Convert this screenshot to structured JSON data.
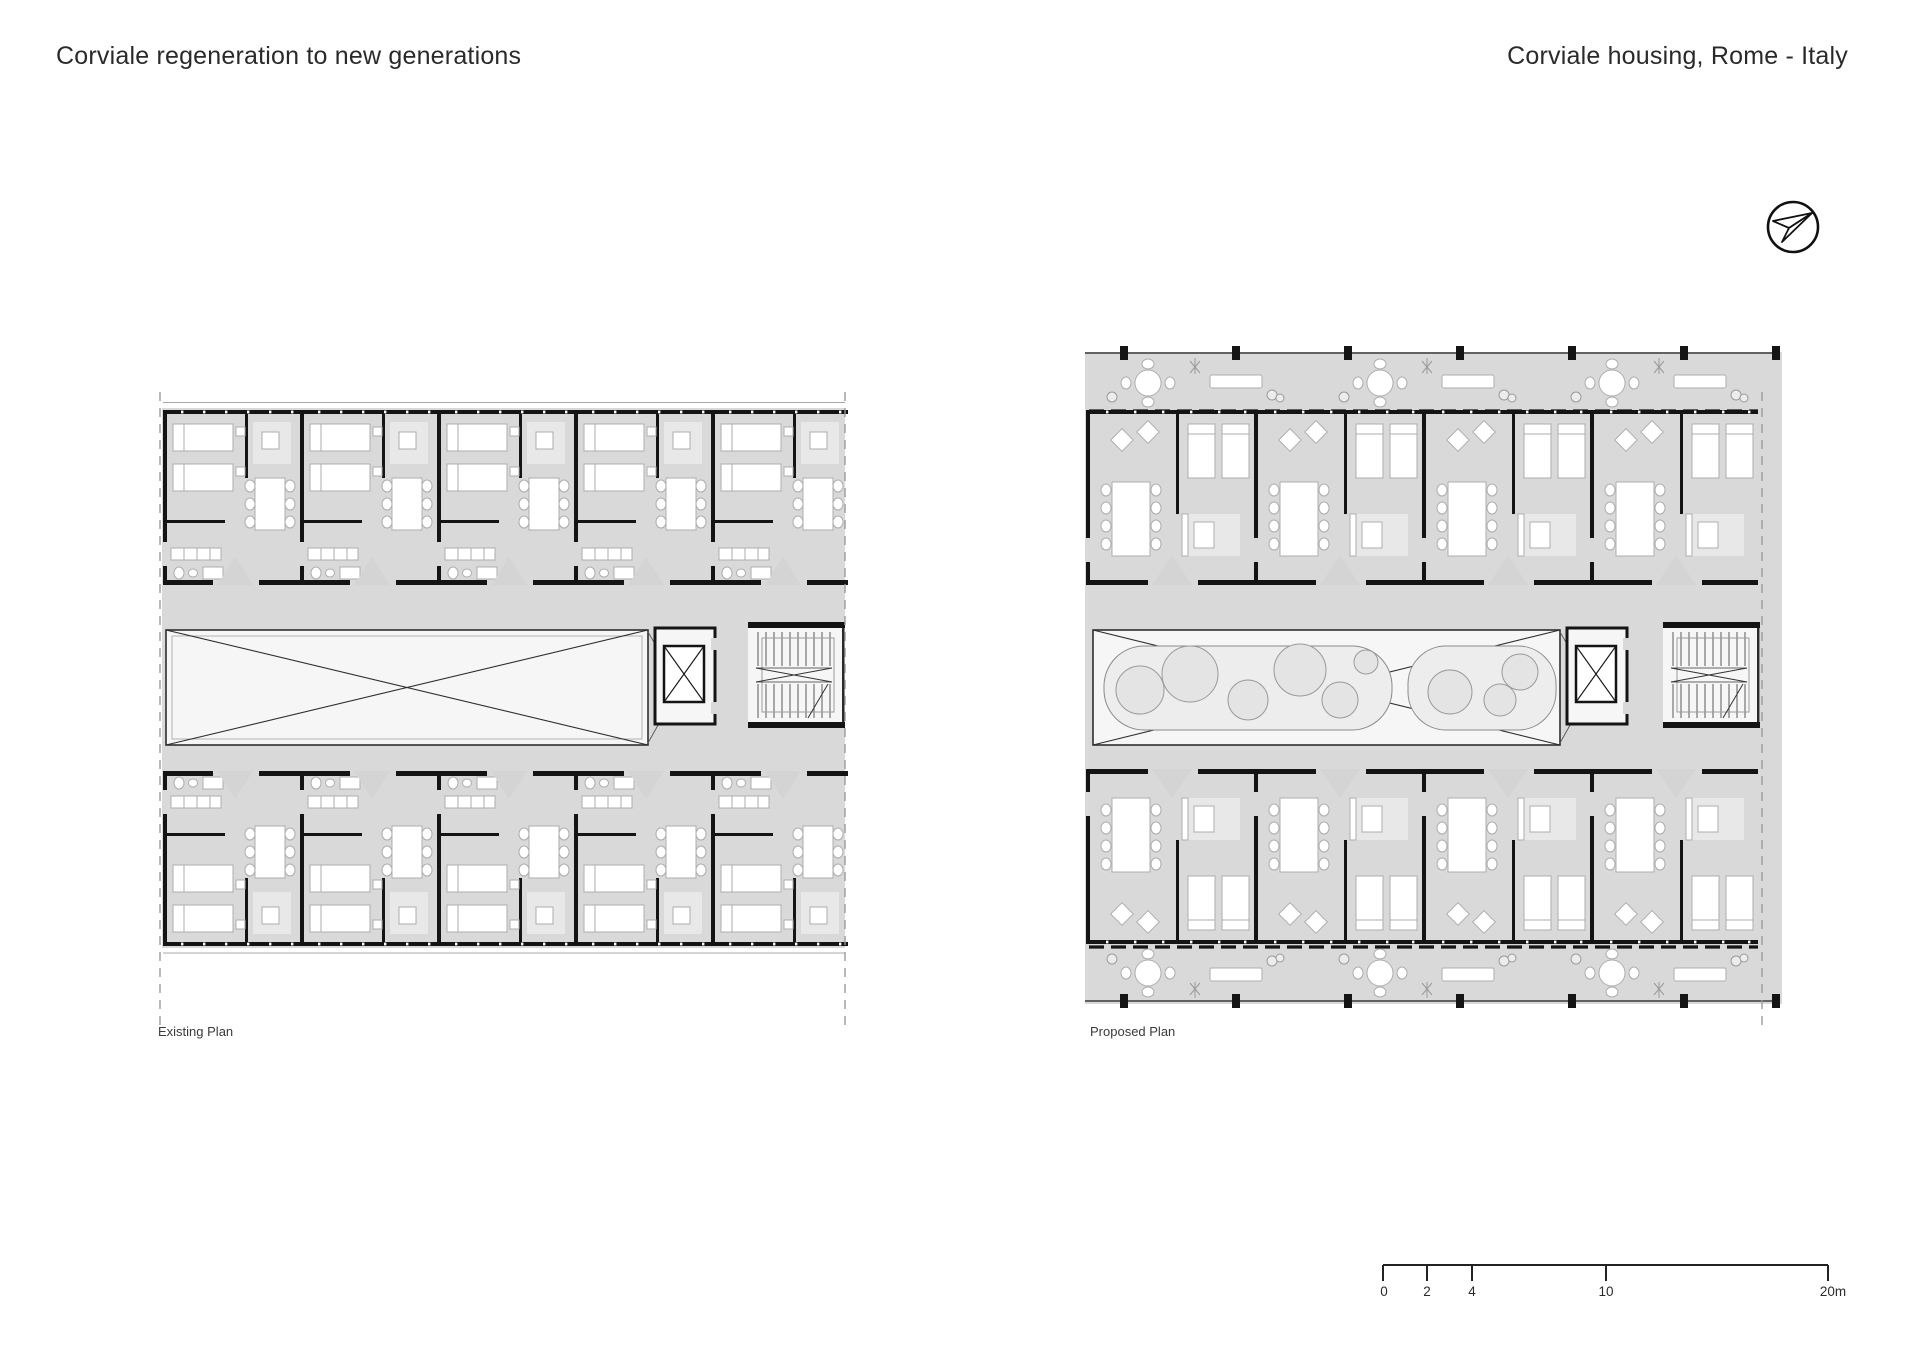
{
  "header": {
    "title_left": "Corviale regeneration to new generations",
    "title_right": "Corviale housing, Rome - Italy"
  },
  "plans": [
    {
      "label": "Existing Plan"
    },
    {
      "label": "Proposed Plan"
    }
  ],
  "scale_bar": {
    "unit": "m",
    "ticks": [
      "0",
      "2",
      "4",
      "10",
      "20m"
    ]
  },
  "icons": {
    "north_arrow": "north-arrow-compass"
  },
  "colors": {
    "background": "#ffffff",
    "floor_gray": "#d9d9d9",
    "wall_black": "#141414",
    "void_white": "#f6f6f6",
    "detail_line": "#8a8a8a"
  }
}
